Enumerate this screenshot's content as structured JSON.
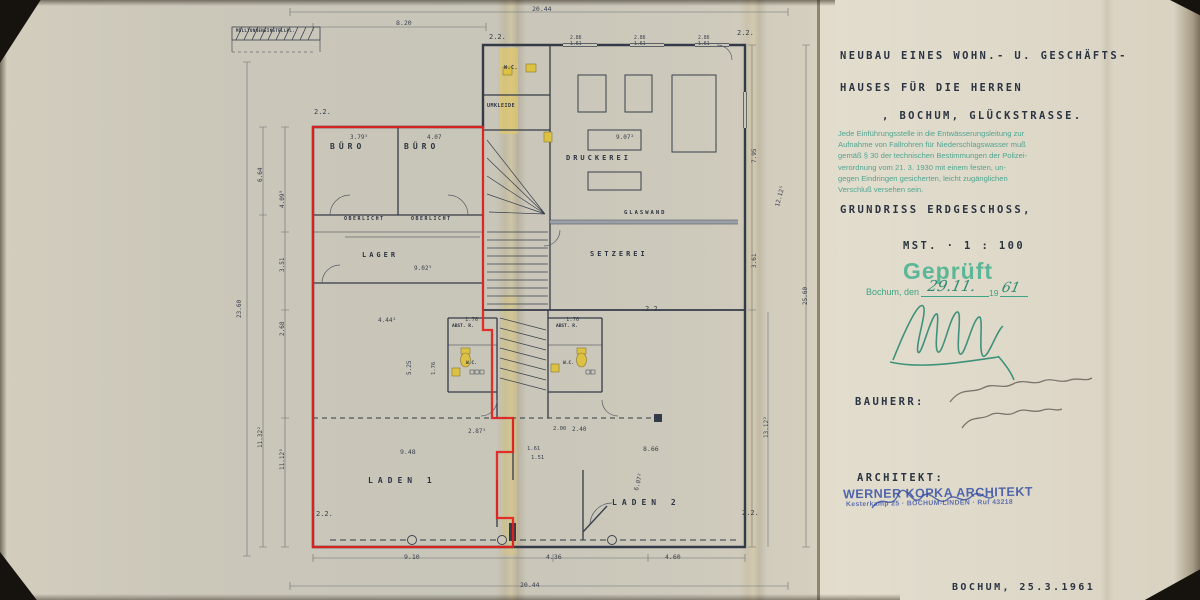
{
  "colors": {
    "paper": "#cdc8ba",
    "paper_right_panel": "#dad4c5",
    "drawing_ink": "#2b3442",
    "red_outline": "#e2231f",
    "regulation_stamp_teal": "#3f9f8a",
    "approval_stamp_green": "#45b18f",
    "architect_stamp_blue": "#3c55a8",
    "pencil_signature": "#635c52",
    "fixture_yellow": "#dcc145"
  },
  "title_block": {
    "project_line1": "NEUBAU EINES WOHN.- U. GESCHÄFTS-",
    "project_line2": "HAUSES FÜR DIE HERREN",
    "project_line3": ", BOCHUM, GLÜCKSTRASSE.",
    "regulation_stamp_lines": [
      "Jede Einführungsstelle in die Entwässerungsleitung zur",
      "Aufnahme von Fallrohren für Niederschlagswasser muß",
      "gemäß § 30 der technischen Bestimmungen der Polizei-",
      "verordnung vom 21. 3. 1930 mit einem festen, un-",
      "gegen Eindringen gesicherten, leicht zugänglichen",
      "Verschluß versehen sein."
    ],
    "drawing_title": "GRUNDRISS ERDGESCHOSS,",
    "scale_label": "MST. · 1 : 100",
    "approval": {
      "stamp_text": "Geprüft",
      "place_label": "Bochum, den",
      "date_handwritten": "29.11.",
      "year_printed": "19",
      "year_handwritten": "61"
    },
    "bauherr_label": "BAUHERR:",
    "architekt_label": "ARCHITEKT:",
    "architect_stamp": {
      "line1": "WERNER KOPKA ARCHITEKT",
      "line2": "Kesterkamp 25 · BOCHUM-LINDEN · Ruf 43218"
    },
    "footer_date": "BOCHUM, 25.3.1961"
  },
  "plan": {
    "room_labels": [
      {
        "t": "BÜRO",
        "x": 330,
        "y": 143,
        "s": 8,
        "ls": 4
      },
      {
        "t": "BÜRO",
        "x": 404,
        "y": 143,
        "s": 8,
        "ls": 4
      },
      {
        "t": "OBERLICHT",
        "x": 344,
        "y": 217,
        "s": 5,
        "ls": 1.5
      },
      {
        "t": "OBERLICHT",
        "x": 411,
        "y": 217,
        "s": 5,
        "ls": 1.5
      },
      {
        "t": "LAGER",
        "x": 362,
        "y": 252,
        "s": 7,
        "ls": 3
      },
      {
        "t": "W.C.",
        "x": 504,
        "y": 66,
        "s": 5,
        "ls": 0.5
      },
      {
        "t": "UMKLEIDE",
        "x": 487,
        "y": 104,
        "s": 5,
        "ls": 0.5
      },
      {
        "t": "DRUCKEREI",
        "x": 566,
        "y": 155,
        "s": 7,
        "ls": 3
      },
      {
        "t": "GLASWAND",
        "x": 624,
        "y": 211,
        "s": 5.5,
        "ls": 2
      },
      {
        "t": "SETZEREI",
        "x": 590,
        "y": 251,
        "s": 7,
        "ls": 3
      },
      {
        "t": "ABST. R.",
        "x": 452,
        "y": 325,
        "s": 4.5,
        "ls": 0
      },
      {
        "t": "W.C.",
        "x": 466,
        "y": 362,
        "s": 4.5,
        "ls": 0
      },
      {
        "t": "ABST. R.",
        "x": 556,
        "y": 325,
        "s": 4.5,
        "ls": 0
      },
      {
        "t": "W.C.",
        "x": 563,
        "y": 362,
        "s": 4.5,
        "ls": 0
      },
      {
        "t": "LADEN 1",
        "x": 368,
        "y": 477,
        "s": 8,
        "ls": 5
      },
      {
        "t": "LADEN 2",
        "x": 612,
        "y": 499,
        "s": 8,
        "ls": 5
      },
      {
        "t": "MÜLLTONNENEINSTELLPL.",
        "x": 236,
        "y": 29,
        "s": 4,
        "ls": 0.4
      }
    ],
    "dimension_labels": [
      {
        "t": "20.44",
        "x": 532,
        "y": 6,
        "s": 6.5
      },
      {
        "t": "8.20",
        "x": 396,
        "y": 20,
        "s": 6.5
      },
      {
        "t": "2.2.",
        "x": 489,
        "y": 34,
        "s": 7
      },
      {
        "t": "2.86",
        "x": 570,
        "y": 37,
        "s": 4.8
      },
      {
        "t": "1.61",
        "x": 570,
        "y": 43,
        "s": 4.8
      },
      {
        "t": "2.86",
        "x": 634,
        "y": 37,
        "s": 4.8
      },
      {
        "t": "1.61",
        "x": 634,
        "y": 43,
        "s": 4.8
      },
      {
        "t": "2.86",
        "x": 698,
        "y": 37,
        "s": 4.8
      },
      {
        "t": "1.61",
        "x": 698,
        "y": 43,
        "s": 4.8
      },
      {
        "t": "2.2.",
        "x": 737,
        "y": 30,
        "s": 7
      },
      {
        "t": "2.2.",
        "x": 314,
        "y": 109,
        "s": 7
      },
      {
        "t": "3.79⁵",
        "x": 350,
        "y": 135,
        "s": 6
      },
      {
        "t": "4.07",
        "x": 427,
        "y": 135,
        "s": 6
      },
      {
        "t": "9.02⁵",
        "x": 414,
        "y": 266,
        "s": 6
      },
      {
        "t": "9.07²",
        "x": 616,
        "y": 135,
        "s": 6
      },
      {
        "t": "4.44²",
        "x": 378,
        "y": 318,
        "s": 6
      },
      {
        "t": "1.76",
        "x": 465,
        "y": 318,
        "s": 5.5
      },
      {
        "t": "1.76",
        "x": 566,
        "y": 318,
        "s": 5.5
      },
      {
        "t": "5.25",
        "x": 407,
        "y": 375,
        "s": 6,
        "r": -90
      },
      {
        "t": "1.76",
        "x": 432,
        "y": 375,
        "s": 5.5,
        "r": -90
      },
      {
        "t": "2.00",
        "x": 553,
        "y": 427,
        "s": 5.5
      },
      {
        "t": "2.40",
        "x": 572,
        "y": 427,
        "s": 6
      },
      {
        "t": "1.61",
        "x": 527,
        "y": 447,
        "s": 5.5
      },
      {
        "t": "2.87⁵",
        "x": 468,
        "y": 429,
        "s": 6
      },
      {
        "t": "9.48",
        "x": 400,
        "y": 449,
        "s": 6.5
      },
      {
        "t": "8.66",
        "x": 643,
        "y": 446,
        "s": 6.5
      },
      {
        "t": "6.07²",
        "x": 634,
        "y": 490,
        "s": 6,
        "r": -75
      },
      {
        "t": "2.2.",
        "x": 316,
        "y": 511,
        "s": 7
      },
      {
        "t": "2.2.",
        "x": 742,
        "y": 510,
        "s": 7
      },
      {
        "t": "2.2.",
        "x": 645,
        "y": 306,
        "s": 7
      },
      {
        "t": "9.10",
        "x": 404,
        "y": 554,
        "s": 6.5
      },
      {
        "t": "4.36",
        "x": 546,
        "y": 554,
        "s": 6.5
      },
      {
        "t": "4.60",
        "x": 665,
        "y": 554,
        "s": 6.5
      },
      {
        "t": "20.44",
        "x": 520,
        "y": 582,
        "s": 6.5
      },
      {
        "t": "23.60",
        "x": 237,
        "y": 318,
        "s": 6,
        "r": -90
      },
      {
        "t": "6.64",
        "x": 258,
        "y": 182,
        "s": 6,
        "r": -90
      },
      {
        "t": "11.32²",
        "x": 258,
        "y": 448,
        "s": 6,
        "r": -90
      },
      {
        "t": "4.09⁵",
        "x": 280,
        "y": 208,
        "s": 6,
        "r": -90
      },
      {
        "t": "3.51",
        "x": 280,
        "y": 272,
        "s": 6,
        "r": -90
      },
      {
        "t": "2.68",
        "x": 280,
        "y": 336,
        "s": 6,
        "r": -90
      },
      {
        "t": "11.12⁵",
        "x": 280,
        "y": 470,
        "s": 6,
        "r": -90
      },
      {
        "t": "7.95",
        "x": 752,
        "y": 163,
        "s": 6,
        "r": -90
      },
      {
        "t": "3.61",
        "x": 752,
        "y": 268,
        "s": 6,
        "r": -90
      },
      {
        "t": "12.12⁵",
        "x": 775,
        "y": 206,
        "s": 6,
        "r": -75
      },
      {
        "t": "25.60",
        "x": 803,
        "y": 305,
        "s": 6,
        "r": -90
      },
      {
        "t": "13.12²",
        "x": 764,
        "y": 438,
        "s": 6,
        "r": -90
      },
      {
        "t": "1.51",
        "x": 531,
        "y": 456,
        "s": 5.5
      }
    ]
  }
}
